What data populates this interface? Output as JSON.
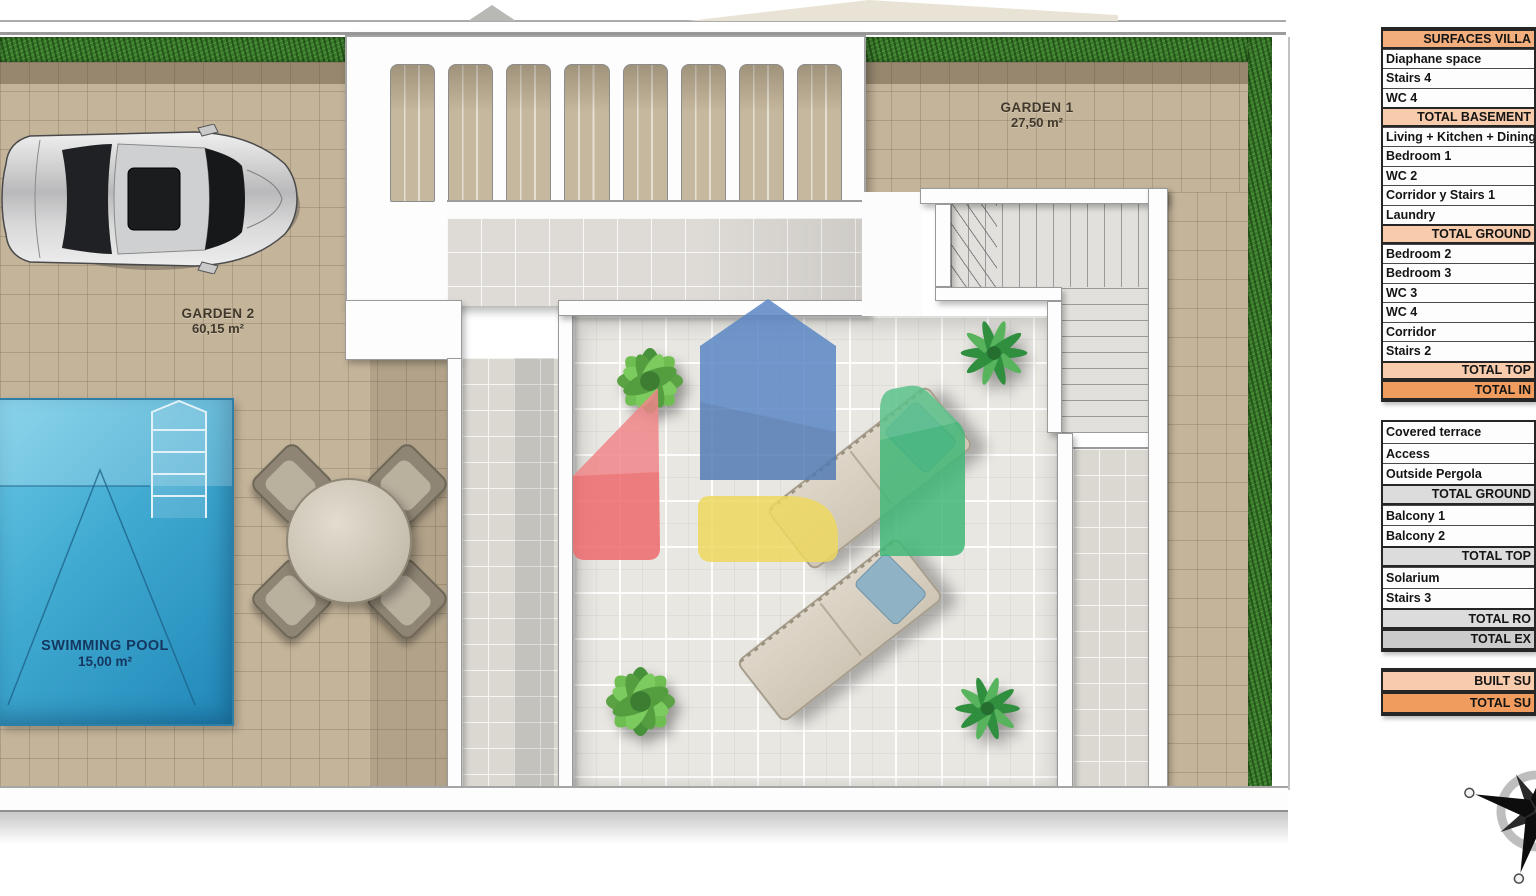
{
  "plan": {
    "garden1": {
      "name": "GARDEN 1",
      "area": "27,50 m²"
    },
    "garden2": {
      "name": "GARDEN 2",
      "area": "60,15 m²"
    },
    "pool": {
      "name": "SWIMMING POOL",
      "area": "15,00 m²"
    }
  },
  "tables": {
    "surfaces_villa": {
      "rows": [
        {
          "label": "SURFACES VILLA",
          "type": "header"
        },
        {
          "label": "Diaphane space",
          "type": "item"
        },
        {
          "label": "Stairs 4",
          "type": "item"
        },
        {
          "label": "WC 4",
          "type": "item"
        },
        {
          "label": "TOTAL BASEMENT",
          "type": "subtotal"
        },
        {
          "label": "Living + Kitchen + Dining",
          "type": "item"
        },
        {
          "label": "Bedroom 1",
          "type": "item"
        },
        {
          "label": "WC 2",
          "type": "item"
        },
        {
          "label": "Corridor y Stairs 1",
          "type": "item"
        },
        {
          "label": "Laundry",
          "type": "item"
        },
        {
          "label": "TOTAL GROUND",
          "type": "subtotal"
        },
        {
          "label": "Bedroom 2",
          "type": "item"
        },
        {
          "label": "Bedroom 3",
          "type": "item"
        },
        {
          "label": "WC 3",
          "type": "item"
        },
        {
          "label": "WC 4",
          "type": "item"
        },
        {
          "label": "Corridor",
          "type": "item"
        },
        {
          "label": "Stairs 2",
          "type": "item"
        },
        {
          "label": "TOTAL TOP",
          "type": "subtotal"
        },
        {
          "label": "TOTAL IN",
          "type": "total"
        }
      ]
    },
    "outside_surfaces": {
      "rows": [
        {
          "label": "Covered terrace",
          "type": "item"
        },
        {
          "label": "Access",
          "type": "item"
        },
        {
          "label": "Outside Pergola",
          "type": "item"
        },
        {
          "label": "TOTAL GROUND",
          "type": "subtotal-gray"
        },
        {
          "label": "Balcony 1",
          "type": "item"
        },
        {
          "label": "Balcony 2",
          "type": "item"
        },
        {
          "label": "TOTAL TOP",
          "type": "subtotal-gray"
        },
        {
          "label": "Solarium",
          "type": "item"
        },
        {
          "label": "Stairs 3",
          "type": "item"
        },
        {
          "label": "TOTAL RO",
          "type": "subtotal-gray"
        },
        {
          "label": "TOTAL EX",
          "type": "total-gray"
        }
      ]
    },
    "totals": {
      "rows": [
        {
          "label": "BUILT SU",
          "type": "subtotal"
        },
        {
          "label": "TOTAL SU",
          "type": "total"
        }
      ]
    }
  },
  "colors": {
    "table_header_orange": "#f2ae7c",
    "table_subtotal_orange": "#f8cbad",
    "table_total_orange": "#ef9c5e",
    "table_subtotal_gray": "#dcdcdc",
    "table_total_gray": "#cbcbcb",
    "hedge_green": "#3a7a2c",
    "paving_tan": "#c4b49a",
    "pool_blue": "#3fa9d0",
    "logo_blue": "#5b87c5",
    "logo_red": "#ee6a6d",
    "logo_yellow": "#eed95f",
    "logo_green": "#41b878"
  }
}
